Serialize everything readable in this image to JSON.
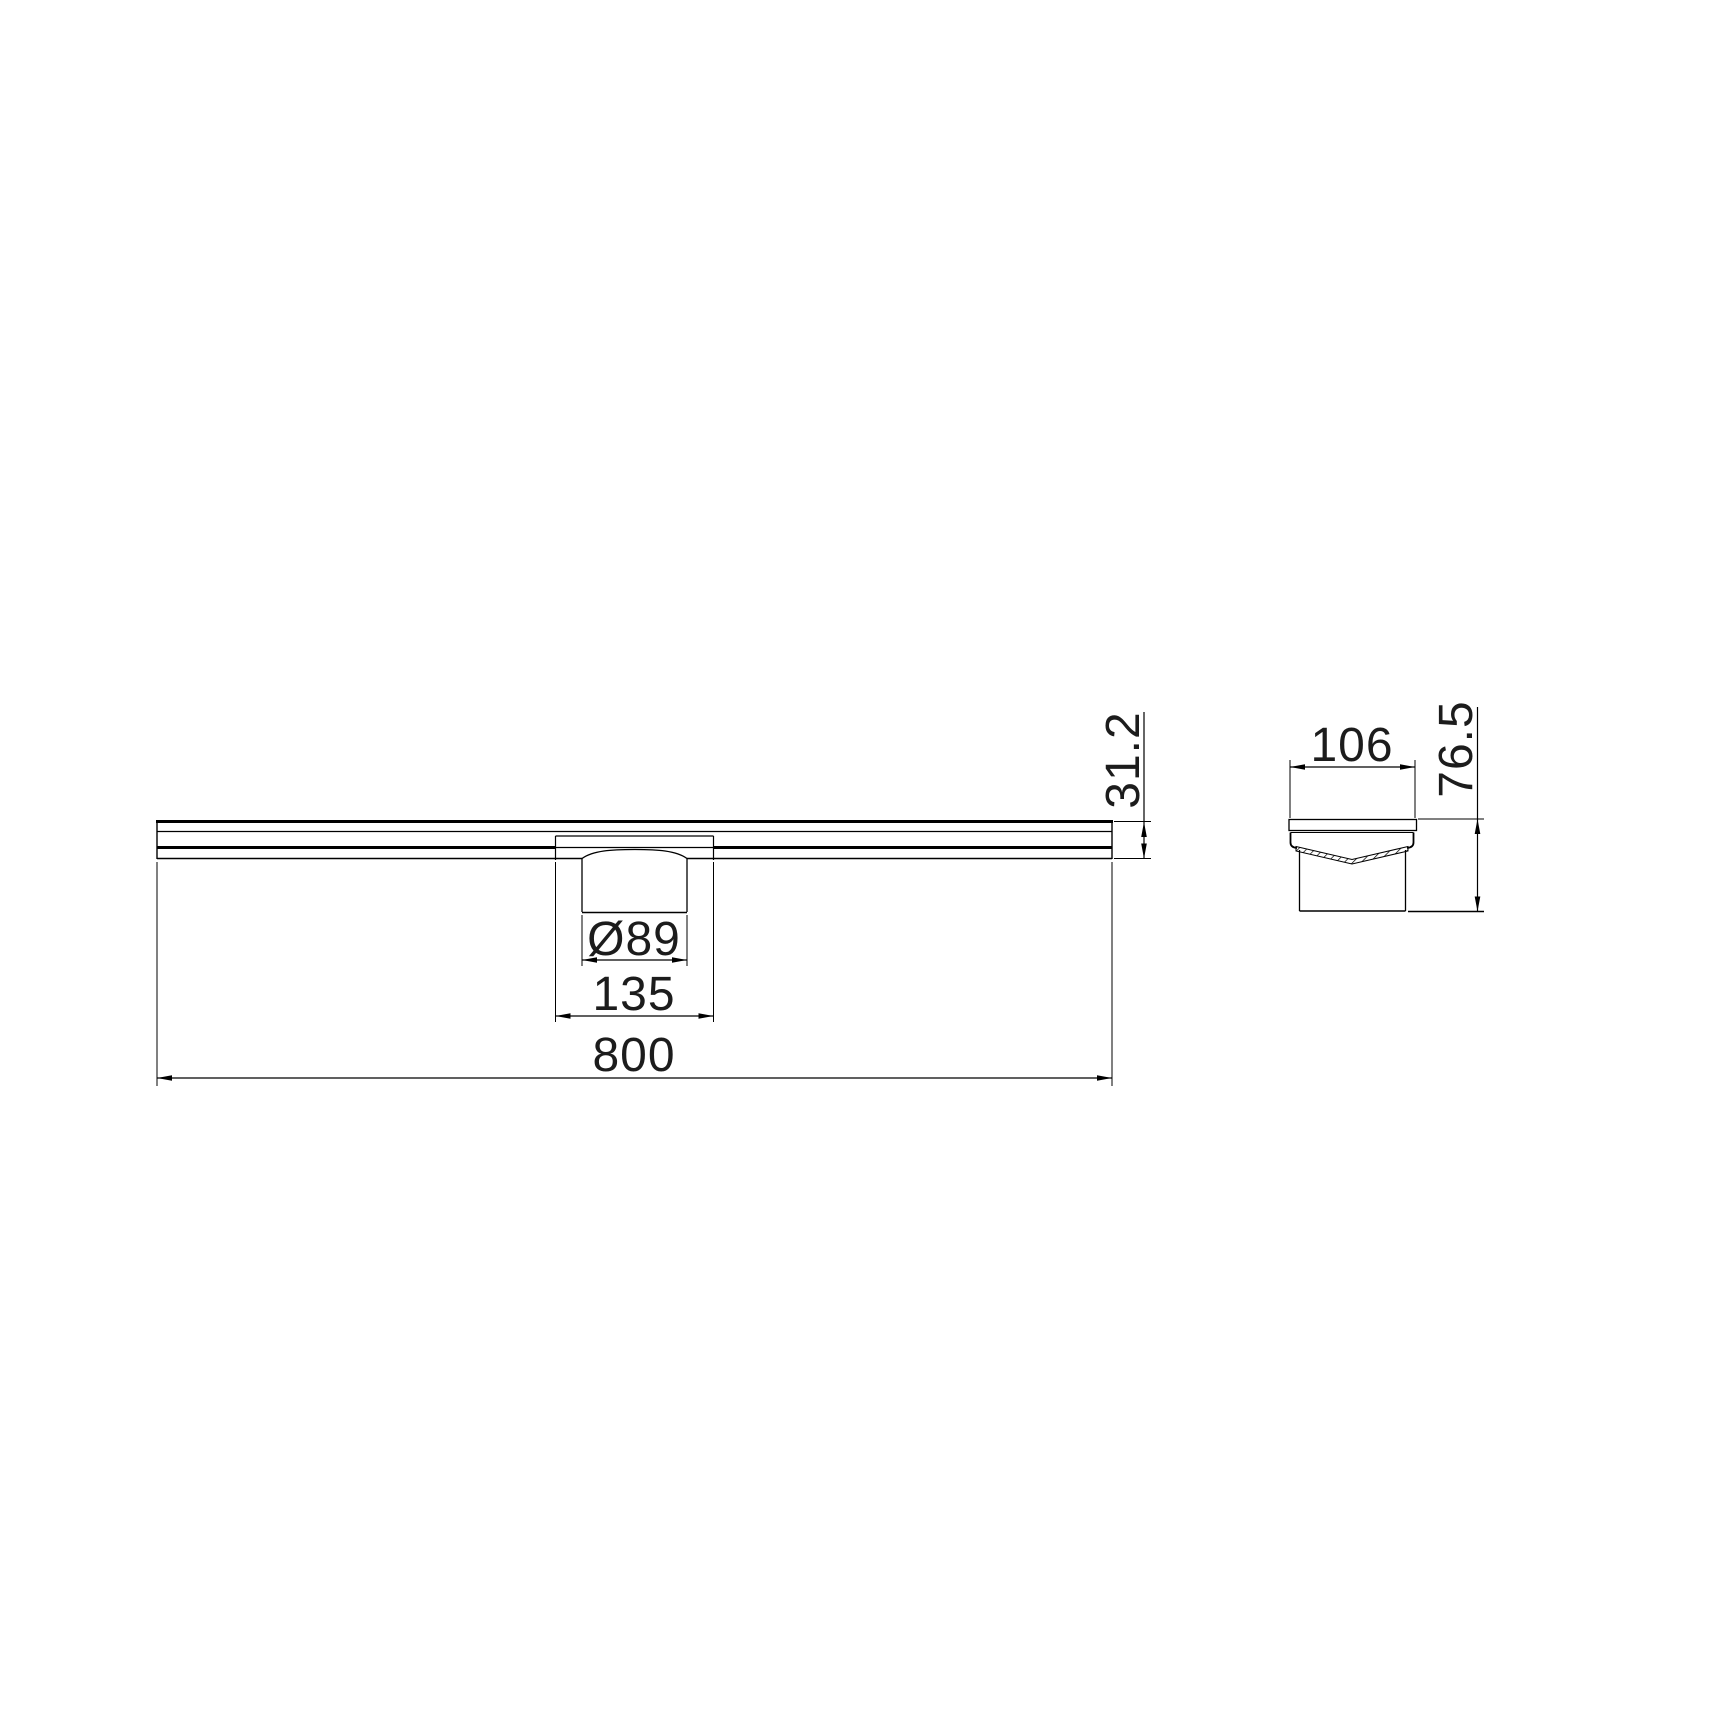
{
  "page": {
    "background": "#ffffff"
  },
  "drawing": {
    "type": "technical-dimension-drawing",
    "subject": "linear-drain-channel",
    "line_color": "#000000",
    "text_color": "#1c1c1c",
    "views": {
      "front": {
        "label": "front-elevation",
        "dimensions": {
          "overall_length": "800",
          "outlet_housing_width": "135",
          "outlet_diameter": "Ø89",
          "body_height": "31.2"
        }
      },
      "section": {
        "label": "end-cross-section",
        "dimensions": {
          "channel_width": "106",
          "overall_height": "76.5"
        }
      }
    }
  }
}
